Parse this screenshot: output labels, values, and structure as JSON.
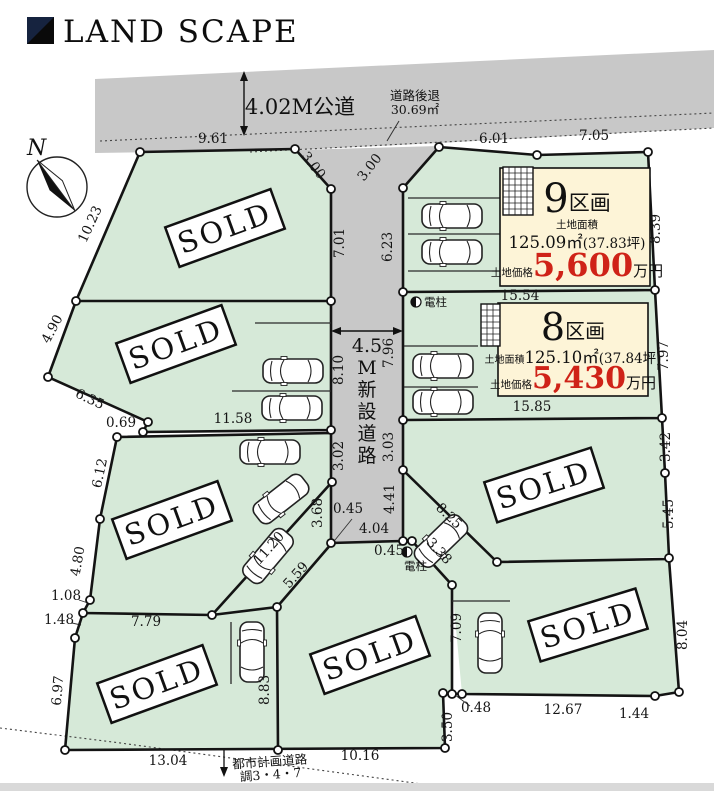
{
  "header": {
    "logo_text": "LAND SCAPE"
  },
  "compass": {
    "north_label": "N"
  },
  "roads": {
    "public_road": "4.02M公道",
    "setback_line1": "道路後退",
    "setback_line2": "30.69㎡",
    "new_road_prefix": "4.5",
    "new_road_char1": "M",
    "new_road_char2": "新",
    "new_road_char3": "設",
    "new_road_char4": "道",
    "new_road_char5": "路",
    "plan_road_line1": "都市計画道路",
    "plan_road_line2": "調3・4・7",
    "pole_label1": "電柱",
    "pole_label2": "電柱"
  },
  "stamp": {
    "label": "SOLD"
  },
  "lots": {
    "lot9": {
      "name_num": "9",
      "name_suffix": "区画",
      "area_label": "土地面積",
      "area_value": "125.09㎡",
      "area_tsubo": "(37.83坪)",
      "price_label": "土地価格",
      "price_value": "5,600",
      "price_unit": "万円"
    },
    "lot8": {
      "name_num": "8",
      "name_suffix": "区画",
      "area_label": "土地面積",
      "area_value": "125.10㎡",
      "area_tsubo": "(37.84坪)",
      "price_label": "土地価格",
      "price_value": "5,430",
      "price_unit": "万円"
    }
  },
  "colors": {
    "accent_red": "#cf2318",
    "land_green": "#d6e9d8",
    "road_gray": "#c8c8c8",
    "box_cream": "#fdf4d7",
    "logo_navy": "#16233f",
    "bottom_strip": "#d9d9d9"
  },
  "measurements": [
    {
      "v": "9.61",
      "x": 213,
      "y": 143,
      "r": 0
    },
    {
      "v": "3.00",
      "x": 310,
      "y": 168,
      "r": 52
    },
    {
      "v": "3.00",
      "x": 373,
      "y": 170,
      "r": -52
    },
    {
      "v": "6.01",
      "x": 494,
      "y": 143,
      "r": 0
    },
    {
      "v": "7.05",
      "x": 594,
      "y": 140,
      "r": 0
    },
    {
      "v": "10.23",
      "x": 94,
      "y": 226,
      "r": -65
    },
    {
      "v": "7.01",
      "x": 344,
      "y": 243,
      "r": -90
    },
    {
      "v": "6.23",
      "x": 392,
      "y": 247,
      "r": -90
    },
    {
      "v": "8.39",
      "x": 660,
      "y": 229,
      "r": -90
    },
    {
      "v": "15.54",
      "x": 520,
      "y": 300,
      "r": 0
    },
    {
      "v": "7.97",
      "x": 668,
      "y": 356,
      "r": -90
    },
    {
      "v": "15.85",
      "x": 532,
      "y": 411,
      "r": 0
    },
    {
      "v": "4.90",
      "x": 56,
      "y": 331,
      "r": -62
    },
    {
      "v": "6.35",
      "x": 88,
      "y": 403,
      "r": 25
    },
    {
      "v": "0.69",
      "x": 121,
      "y": 427,
      "r": 0
    },
    {
      "v": "11.58",
      "x": 233,
      "y": 423,
      "r": 0
    },
    {
      "v": "8.10",
      "x": 343,
      "y": 370,
      "r": -90
    },
    {
      "v": "7.96",
      "x": 393,
      "y": 353,
      "r": -90
    },
    {
      "v": "3.02",
      "x": 343,
      "y": 456,
      "r": -90
    },
    {
      "v": "3.03",
      "x": 393,
      "y": 447,
      "r": -90
    },
    {
      "v": "6.12",
      "x": 104,
      "y": 474,
      "r": -78
    },
    {
      "v": "4.80",
      "x": 82,
      "y": 562,
      "r": -80
    },
    {
      "v": "3.68",
      "x": 322,
      "y": 513,
      "r": -90
    },
    {
      "v": "0.45",
      "x": 348,
      "y": 513,
      "r": 0
    },
    {
      "v": "4.04",
      "x": 374,
      "y": 533,
      "r": 0
    },
    {
      "v": "4.41",
      "x": 394,
      "y": 499,
      "r": -90
    },
    {
      "v": "0.45",
      "x": 389,
      "y": 555,
      "r": 0
    },
    {
      "v": "11.20",
      "x": 272,
      "y": 551,
      "r": -48
    },
    {
      "v": "5.59",
      "x": 299,
      "y": 578,
      "r": -48
    },
    {
      "v": "8.25",
      "x": 446,
      "y": 519,
      "r": 44
    },
    {
      "v": "3.38",
      "x": 436,
      "y": 554,
      "r": 47
    },
    {
      "v": "3.42",
      "x": 670,
      "y": 447,
      "r": -90
    },
    {
      "v": "5.45",
      "x": 673,
      "y": 514,
      "r": -90
    },
    {
      "v": "1.08",
      "x": 66,
      "y": 600,
      "r": 0
    },
    {
      "v": "1.48",
      "x": 59,
      "y": 624,
      "r": 0
    },
    {
      "v": "7.79",
      "x": 146,
      "y": 626,
      "r": 0
    },
    {
      "v": "6.97",
      "x": 62,
      "y": 691,
      "r": -85
    },
    {
      "v": "8.83",
      "x": 269,
      "y": 690,
      "r": -90
    },
    {
      "v": "13.04",
      "x": 168,
      "y": 765,
      "r": 0
    },
    {
      "v": "10.16",
      "x": 360,
      "y": 760,
      "r": 0
    },
    {
      "v": "3.50",
      "x": 452,
      "y": 727,
      "r": -90
    },
    {
      "v": "0.48",
      "x": 476,
      "y": 712,
      "r": 0
    },
    {
      "v": "7.09",
      "x": 461,
      "y": 628,
      "r": -90
    },
    {
      "v": "12.67",
      "x": 563,
      "y": 714,
      "r": 0
    },
    {
      "v": "1.44",
      "x": 634,
      "y": 718,
      "r": 0
    },
    {
      "v": "8.04",
      "x": 687,
      "y": 635,
      "r": -90
    }
  ]
}
